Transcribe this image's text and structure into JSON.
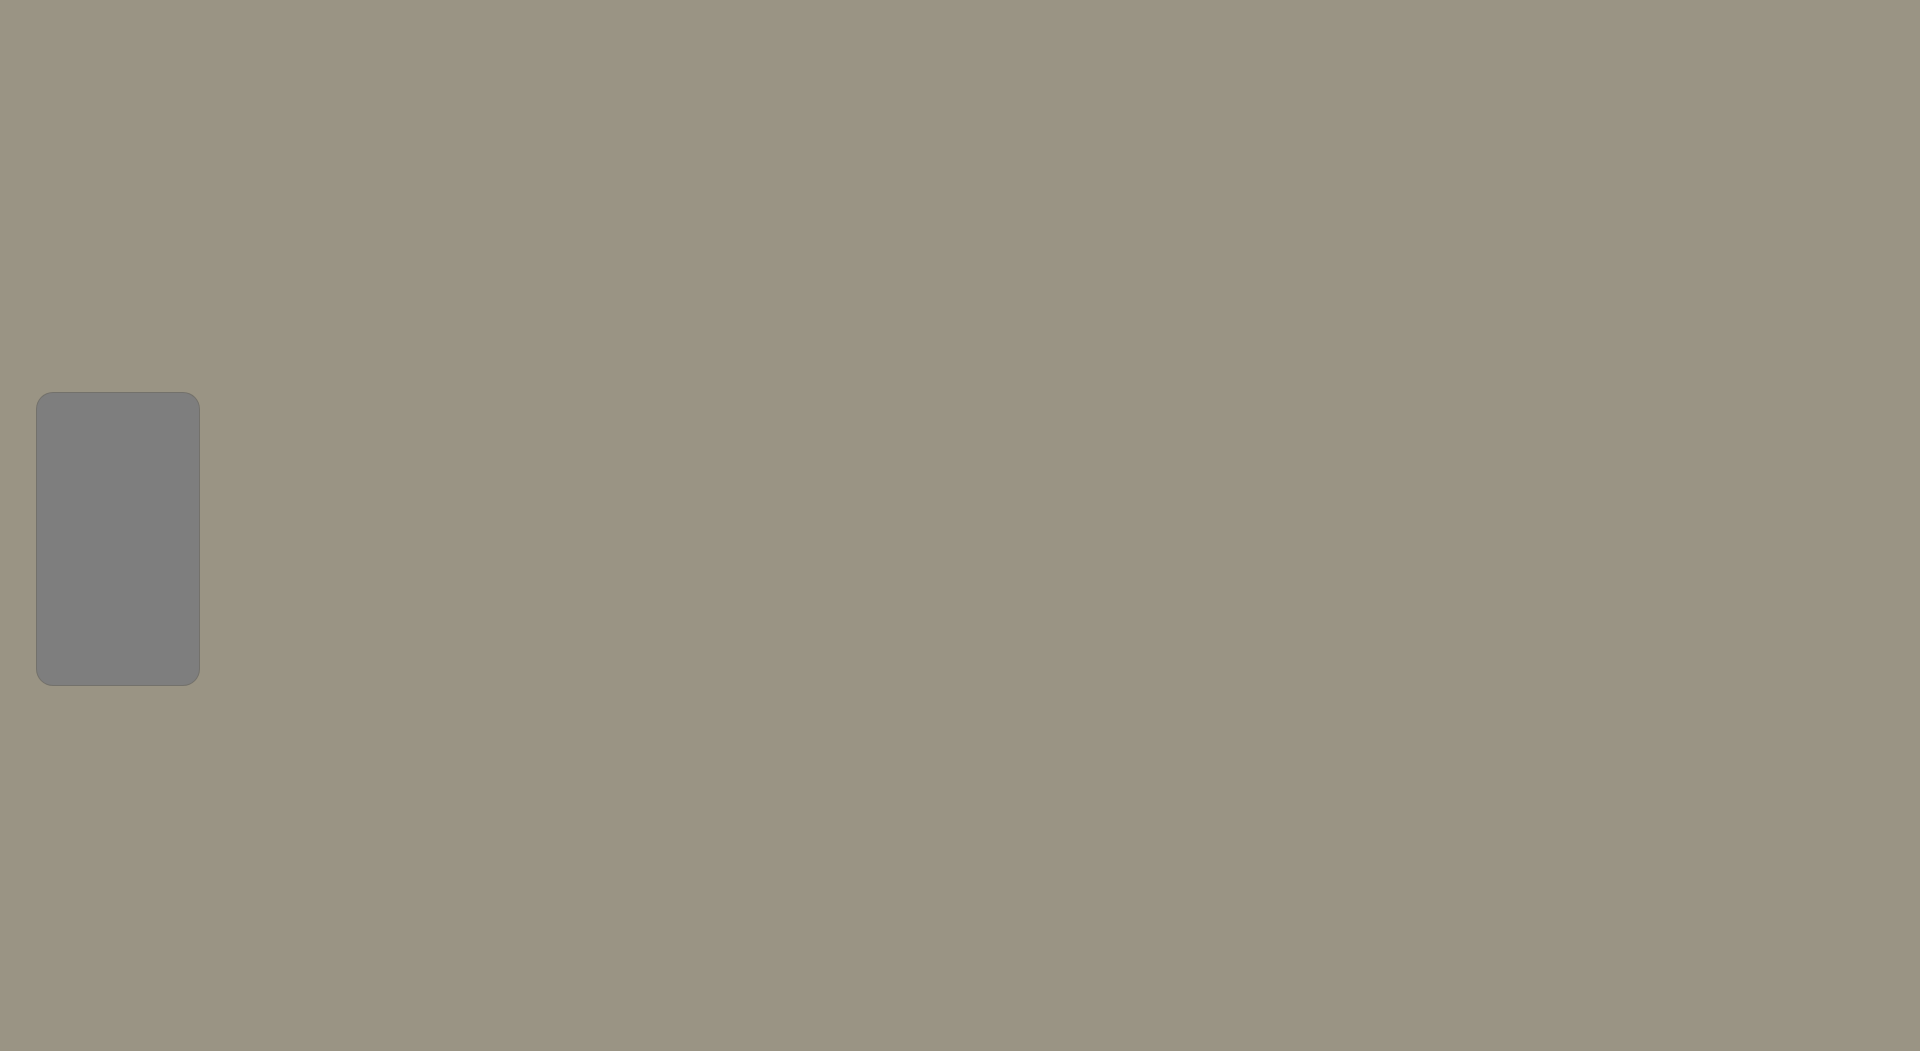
{
  "legend": {
    "title": "Storm Water System",
    "items": [
      {
        "label": "Inlet",
        "symbol": "square",
        "color": "#ed1c0d"
      },
      {
        "label": "Outfall",
        "symbol": "diamond",
        "color": "#f4f163"
      },
      {
        "label": "Pond",
        "symbol": "pentagon",
        "color": "#38c9f1"
      },
      {
        "label": "Mains",
        "symbol": "line",
        "color": "#e9e96a"
      },
      {
        "label": "Outlet",
        "symbol": "triangle",
        "color": "#a31bcd"
      }
    ]
  },
  "highway_shields": [
    {
      "label": "50",
      "shape": "us",
      "x": 495,
      "y": 13
    },
    {
      "label": "83",
      "shape": "us",
      "x": 537,
      "y": 13
    },
    {
      "label": "156",
      "shape": "circle",
      "x": 1553,
      "y": 184
    },
    {
      "label": "83",
      "shape": "us",
      "x": 1243,
      "y": 893
    },
    {
      "label": "50",
      "shape": "us",
      "x": 1556,
      "y": 936
    },
    {
      "label": "50",
      "shape": "us",
      "x": 1868,
      "y": 948
    },
    {
      "label": "83",
      "shape": "us",
      "x": 618,
      "y": 1014
    }
  ],
  "street_labels": [
    {
      "text": "W MARY ST",
      "x": 228,
      "y": 289,
      "rot": 0,
      "style": "light",
      "size": 12
    },
    {
      "text": "W MARY ST",
      "x": 583,
      "y": 300,
      "rot": 0,
      "style": "light",
      "size": 13
    },
    {
      "text": "E MARY ST",
      "x": 1085,
      "y": 314,
      "rot": 0,
      "style": "light",
      "size": 13
    },
    {
      "text": "E MARY ST",
      "x": 1729,
      "y": 330,
      "rot": -2,
      "style": "light",
      "size": 13
    },
    {
      "text": "W FAIR ST",
      "x": 729,
      "y": 419,
      "rot": 0,
      "style": "dark",
      "size": 11
    },
    {
      "text": "E FAIR ST",
      "x": 879,
      "y": 423,
      "rot": 0,
      "style": "dark",
      "size": 11
    },
    {
      "text": "W CAMPBELL ST",
      "x": 597,
      "y": 466,
      "rot": 0,
      "style": "dark",
      "size": 11
    },
    {
      "text": "N TAYLOR AVE",
      "x": 527,
      "y": 447,
      "rot": -90,
      "style": "light",
      "size": 11
    },
    {
      "text": "N TAYLOR AVE",
      "x": 529,
      "y": 712,
      "rot": -90,
      "style": "light",
      "size": 10
    },
    {
      "text": "N 8TH ST",
      "x": 667,
      "y": 470,
      "rot": -90,
      "style": "light",
      "size": 11
    },
    {
      "text": "N 8TH ST",
      "x": 660,
      "y": 700,
      "rot": -90,
      "style": "light",
      "size": 10
    },
    {
      "text": "N 3RD ST",
      "x": 823,
      "y": 468,
      "rot": -90,
      "style": "light",
      "size": 11
    },
    {
      "text": "N MAIN ST",
      "x": 756,
      "y": 478,
      "rot": -90,
      "style": "light",
      "size": 10
    },
    {
      "text": "N MAIN ST",
      "x": 691,
      "y": 722,
      "rot": -78,
      "style": "light",
      "size": 11
    },
    {
      "text": "N 4TH ST",
      "x": 777,
      "y": 731,
      "rot": -90,
      "style": "light",
      "size": 11
    },
    {
      "text": "CENTER ST",
      "x": 937,
      "y": 532,
      "rot": -90,
      "style": "dark",
      "size": 10
    },
    {
      "text": "FLEMING ST",
      "x": 1018,
      "y": 227,
      "rot": -90,
      "style": "dark",
      "size": 10
    },
    {
      "text": "FLEMING ST",
      "x": 1007,
      "y": 571,
      "rot": -90,
      "style": "dark",
      "size": 10
    },
    {
      "text": "FLEMING ST",
      "x": 1000,
      "y": 872,
      "rot": -90,
      "style": "dark",
      "size": 10
    },
    {
      "text": "N CAMPUS DR",
      "x": 1133,
      "y": 460,
      "rot": -90,
      "style": "dark",
      "size": 11
    },
    {
      "text": "N JENNIE BARKER RD",
      "x": 1443,
      "y": 172,
      "rot": -90,
      "style": "light",
      "size": 10
    },
    {
      "text": "N JENNIE BARKER RD",
      "x": 1452,
      "y": 690,
      "rot": -90,
      "style": "light",
      "size": 10
    },
    {
      "text": "BUFFALO JONES AVE",
      "x": 452,
      "y": 546,
      "rot": -17,
      "style": "light",
      "size": 11
    },
    {
      "text": "BUFFALO JONES AVE",
      "x": 575,
      "y": 625,
      "rot": 33,
      "style": "light",
      "size": 11
    },
    {
      "text": "W KANSAS AVE",
      "x": 447,
      "y": 600,
      "rot": 0,
      "style": "dark",
      "size": 10
    },
    {
      "text": "W KANSAS AVE",
      "x": 622,
      "y": 603,
      "rot": 0,
      "style": "light",
      "size": 13
    },
    {
      "text": "E KANSAS AVE",
      "x": 947,
      "y": 612,
      "rot": 0,
      "style": "light",
      "size": 13
    },
    {
      "text": "E SCHULMAN AVE",
      "x": 1286,
      "y": 626,
      "rot": 1,
      "style": "dark",
      "size": 11
    },
    {
      "text": "W FULTON ST",
      "x": 362,
      "y": 748,
      "rot": 17,
      "style": "light",
      "size": 11
    },
    {
      "text": "E FULTON ST",
      "x": 897,
      "y": 841,
      "rot": 0,
      "style": "light",
      "size": 12
    },
    {
      "text": "E WALNUT ST",
      "x": 753,
      "y": 691,
      "rot": 8,
      "style": "light",
      "size": 11
    },
    {
      "text": "E PINE ST",
      "x": 728,
      "y": 748,
      "rot": 4,
      "style": "light",
      "size": 11
    },
    {
      "text": "E SPRUCE ST",
      "x": 906,
      "y": 765,
      "rot": 0,
      "style": "light",
      "size": 11
    },
    {
      "text": "E SPRUCE ST",
      "x": 1262,
      "y": 771,
      "rot": 0,
      "style": "dark",
      "size": 11
    },
    {
      "text": "W MAPLE ST",
      "x": 584,
      "y": 856,
      "rot": 15,
      "style": "light",
      "size": 11
    },
    {
      "text": "S MAIN ST",
      "x": 644,
      "y": 898,
      "rot": -80,
      "style": "light",
      "size": 11
    },
    {
      "text": "E US HIGHWAY 50",
      "x": 1177,
      "y": 914,
      "rot": 13,
      "style": "light",
      "size": 13
    },
    {
      "text": "AVE",
      "x": 14,
      "y": 658,
      "rot": 0,
      "style": "light",
      "size": 11
    }
  ],
  "annotations": {
    "question_marks": [
      {
        "text": "??",
        "x": 430,
        "y": 620,
        "size": 17
      },
      {
        "text": "?",
        "x": 748,
        "y": 709,
        "size": 17
      },
      {
        "text": "?",
        "x": 630,
        "y": 728,
        "size": 14
      },
      {
        "text": "?",
        "x": 1459,
        "y": 546,
        "size": 14
      },
      {
        "text": "?",
        "x": 1478,
        "y": 569,
        "size": 14
      },
      {
        "text": "?",
        "x": 1513,
        "y": 578,
        "size": 14
      },
      {
        "text": "??",
        "x": 1537,
        "y": 601,
        "size": 14
      },
      {
        "text": "?",
        "x": 1558,
        "y": 620,
        "size": 14
      },
      {
        "text": "?",
        "x": 1440,
        "y": 463,
        "size": 13
      },
      {
        "text": "?",
        "x": 1470,
        "y": 472,
        "size": 13
      }
    ]
  },
  "colors": {
    "inlet": "#ed1c0d",
    "outfall": "#f4f163",
    "pond": "#38c9f1",
    "mains": "#e9e96a",
    "outlet": "#a31bcd",
    "highway": "#e8391d",
    "boundary": "#111111",
    "legend_bg": "#7e7e7e"
  },
  "network": {
    "mains": [
      [
        [
          240,
          290
        ],
        [
          560,
          297
        ],
        [
          1000,
          303
        ],
        [
          1272,
          309
        ],
        [
          1455,
          318
        ]
      ],
      [
        [
          523,
          419
        ],
        [
          822,
          424
        ],
        [
          1130,
          430
        ]
      ],
      [
        [
          520,
          451
        ],
        [
          940,
          457
        ]
      ],
      [
        [
          350,
          596
        ],
        [
          620,
          602
        ],
        [
          940,
          610
        ],
        [
          1268,
          617
        ]
      ],
      [
        [
          1268,
          617
        ],
        [
          1460,
          627
        ]
      ],
      [
        [
          640,
          758
        ],
        [
          900,
          765
        ],
        [
          1060,
          770
        ],
        [
          1180,
          771
        ],
        [
          1330,
          778
        ]
      ],
      [
        [
          700,
          833
        ],
        [
          940,
          843
        ],
        [
          1100,
          848
        ]
      ],
      [
        [
          620,
          697
        ],
        [
          900,
          706
        ]
      ],
      [
        [
          640,
          743
        ],
        [
          830,
          750
        ]
      ],
      [
        [
          860,
          130
        ],
        [
          1130,
          140
        ]
      ],
      [
        [
          528,
          300
        ],
        [
          527,
          600
        ],
        [
          532,
          880
        ]
      ],
      [
        [
          600,
          420
        ],
        [
          600,
          758
        ]
      ],
      [
        [
          667,
          300
        ],
        [
          667,
          758
        ]
      ],
      [
        [
          755,
          425
        ],
        [
          755,
          530
        ]
      ],
      [
        [
          688,
          640
        ],
        [
          690,
          950
        ]
      ],
      [
        [
          775,
          650
        ],
        [
          777,
          940
        ]
      ],
      [
        [
          822,
          300
        ],
        [
          822,
          648
        ]
      ],
      [
        [
          937,
          428
        ],
        [
          937,
          648
        ]
      ],
      [
        [
          1007,
          130
        ],
        [
          1010,
          430
        ],
        [
          1007,
          770
        ],
        [
          1000,
          920
        ]
      ],
      [
        [
          1133,
          310
        ],
        [
          1133,
          617
        ]
      ],
      [
        [
          1445,
          258
        ],
        [
          1448,
          628
        ]
      ],
      [
        [
          1350,
          565
        ],
        [
          1352,
          640
        ]
      ],
      [
        [
          810,
          95
        ],
        [
          812,
          300
        ]
      ],
      [
        [
          872,
          62
        ],
        [
          872,
          140
        ]
      ],
      [
        [
          395,
          555
        ],
        [
          520,
          598
        ]
      ],
      [
        [
          1452,
          262
        ],
        [
          1536,
          205
        ],
        [
          1610,
          138
        ]
      ],
      [
        [
          450,
          885
        ],
        [
          640,
          855
        ]
      ],
      [
        [
          1540,
          640
        ],
        [
          1705,
          655
        ],
        [
          1722,
          790
        ],
        [
          1868,
          962
        ]
      ],
      [
        [
          1045,
          935
        ],
        [
          1100,
          1000
        ],
        [
          1150,
          1030
        ]
      ],
      [
        [
          660,
          60
        ],
        [
          660,
          300
        ]
      ],
      [
        [
          700,
          12
        ],
        [
          700,
          60
        ]
      ]
    ],
    "ponds": [
      [
        811,
        21
      ],
      [
        986,
        44
      ],
      [
        1071,
        304
      ],
      [
        1051,
        355
      ],
      [
        1098,
        425
      ],
      [
        1096,
        465
      ],
      [
        1038,
        580
      ],
      [
        1145,
        599
      ],
      [
        766,
        711
      ],
      [
        943,
        872
      ],
      [
        495,
        260
      ],
      [
        298,
        497
      ]
    ],
    "outlets": [
      [
        480,
        278
      ],
      [
        700,
        14
      ],
      [
        905,
        122
      ],
      [
        1090,
        300
      ],
      [
        1233,
        317
      ],
      [
        1308,
        318
      ],
      [
        531,
        455
      ],
      [
        610,
        452
      ],
      [
        727,
        455
      ],
      [
        922,
        457
      ],
      [
        913,
        489
      ],
      [
        937,
        610
      ],
      [
        1030,
        620
      ],
      [
        1262,
        695
      ],
      [
        1272,
        721
      ],
      [
        1065,
        841
      ],
      [
        1100,
        871
      ],
      [
        1085,
        901
      ],
      [
        1106,
        916
      ],
      [
        1126,
        941
      ],
      [
        1141,
        956
      ],
      [
        1092,
        961
      ],
      [
        1111,
        986
      ],
      [
        1077,
        996
      ],
      [
        1131,
        1001
      ],
      [
        1161,
        1011
      ],
      [
        660,
        776
      ],
      [
        661,
        941
      ],
      [
        701,
        1006
      ],
      [
        529,
        881
      ],
      [
        1446,
        641
      ],
      [
        1718,
        656
      ],
      [
        1868,
        772
      ],
      [
        1556,
        940
      ],
      [
        1642,
        941
      ],
      [
        1742,
        946
      ],
      [
        1452,
        120
      ],
      [
        1310,
        490
      ],
      [
        868,
        10
      ],
      [
        1278,
        260
      ]
    ],
    "outfalls": [
      [
        352,
        295
      ],
      [
        420,
        341
      ],
      [
        600,
        762
      ],
      [
        640,
        788
      ],
      [
        527,
        906
      ],
      [
        640,
        962
      ],
      [
        657,
        987
      ],
      [
        700,
        1012
      ],
      [
        962,
        931
      ],
      [
        1100,
        894
      ],
      [
        1167,
        909
      ],
      [
        1457,
        321
      ],
      [
        1462,
        630
      ],
      [
        1536,
        206
      ],
      [
        948,
        874
      ],
      [
        1120,
        848
      ],
      [
        660,
        440
      ],
      [
        455,
        392
      ]
    ]
  }
}
